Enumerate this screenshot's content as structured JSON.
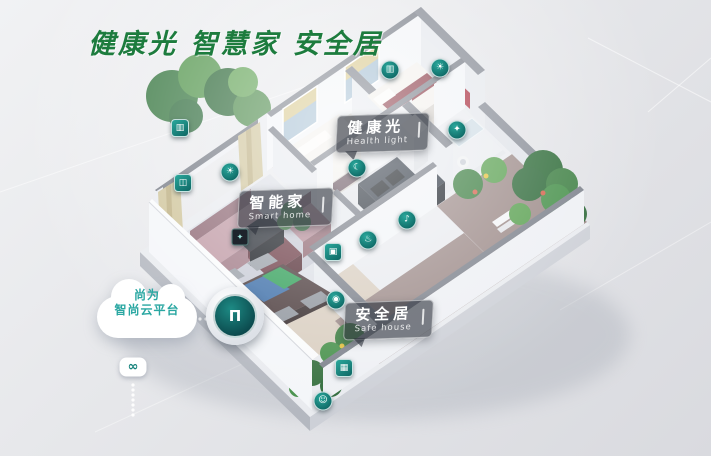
{
  "header": {
    "title": "健康光 智慧家 安全居"
  },
  "colors": {
    "title_green": "#1d7c3e",
    "device_teal": "#16837c",
    "cloud_text_teal": "#2aa7a2"
  },
  "labels": {
    "health_light": {
      "zh": "健康光",
      "en": "Health light"
    },
    "smart_home": {
      "zh": "智能家",
      "en": "Smart home"
    },
    "safe_house": {
      "zh": "安全居",
      "en": "Safe house"
    }
  },
  "cloud": {
    "line1": "尚为",
    "line2": "智尚云平台",
    "link_glyph": "∞"
  },
  "hub": {
    "glyph": "Π"
  },
  "icons": [
    {
      "name": "curtain-control-icon",
      "x": 180,
      "y": 128,
      "shape": "square",
      "glyph": "▥"
    },
    {
      "name": "window-control-icon",
      "x": 183,
      "y": 183,
      "shape": "square",
      "glyph": "◫"
    },
    {
      "name": "light-control-icon",
      "x": 230,
      "y": 172,
      "shape": "circle",
      "glyph": "☀"
    },
    {
      "name": "curtain-motor-icon",
      "x": 390,
      "y": 70,
      "shape": "circle",
      "glyph": "▥"
    },
    {
      "name": "ceiling-light-icon",
      "x": 440,
      "y": 68,
      "shape": "circle",
      "glyph": "☀"
    },
    {
      "name": "wall-light-icon",
      "x": 457,
      "y": 130,
      "shape": "circle",
      "glyph": "✦"
    },
    {
      "name": "sleep-mode-icon",
      "x": 357,
      "y": 168,
      "shape": "circle",
      "glyph": "☾"
    },
    {
      "name": "speaker-icon",
      "x": 407,
      "y": 220,
      "shape": "circle",
      "glyph": "♪"
    },
    {
      "name": "gas-sensor-icon",
      "x": 368,
      "y": 240,
      "shape": "circle",
      "glyph": "♨"
    },
    {
      "name": "switch-panel-icon",
      "x": 333,
      "y": 252,
      "shape": "square",
      "glyph": "▣"
    },
    {
      "name": "security-camera-icon",
      "x": 336,
      "y": 300,
      "shape": "circle",
      "glyph": "◉"
    },
    {
      "name": "env-sensor-icon",
      "x": 344,
      "y": 368,
      "shape": "square",
      "glyph": "▦"
    },
    {
      "name": "video-doorbell-icon",
      "x": 323,
      "y": 401,
      "shape": "circle",
      "glyph": "☺"
    },
    {
      "name": "media-device-icon",
      "x": 240,
      "y": 237,
      "shape": "dark-square",
      "glyph": "✦"
    }
  ]
}
